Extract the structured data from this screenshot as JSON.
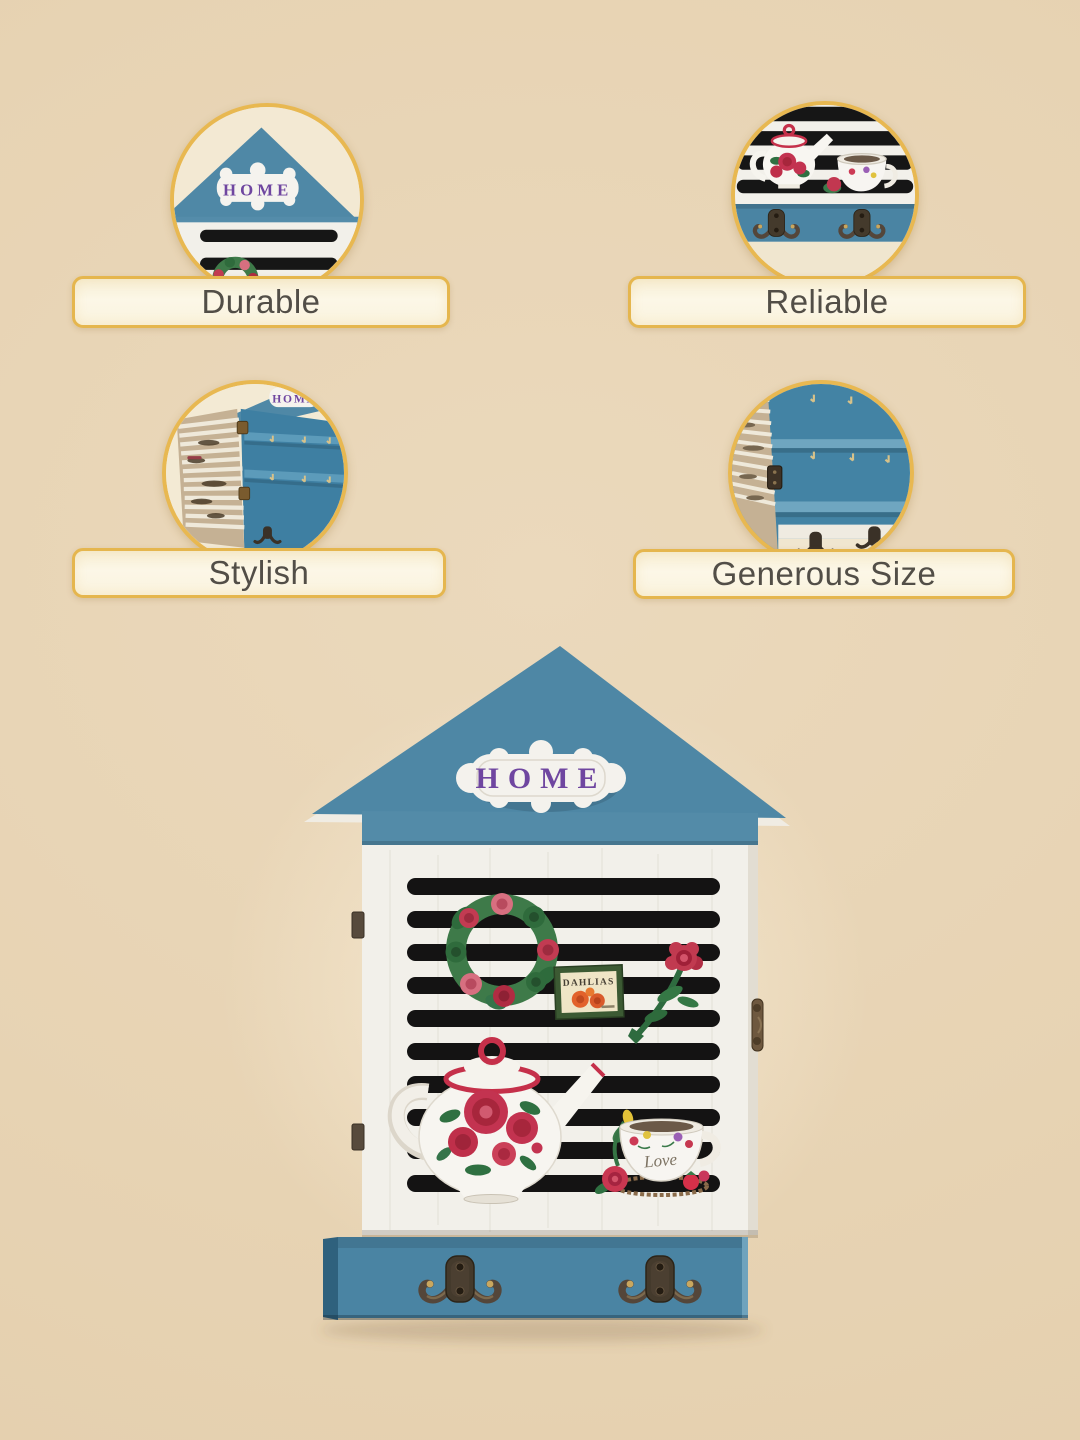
{
  "features": [
    {
      "label": "Durable"
    },
    {
      "label": "Reliable"
    },
    {
      "label": "Stylish"
    },
    {
      "label": "Generous Size"
    }
  ],
  "product": {
    "plaque_text": "HOME",
    "cup_text": "Love",
    "seed_packet_text": "DAHLIAS"
  },
  "colors": {
    "accent_gold": "#E5B64E",
    "pill_background": "#FAF3DE",
    "label_text": "#524E47",
    "roof_blue": "#4E87A5",
    "interior_blue": "#3F7EA0",
    "bar_blue": "#4A84A3",
    "body_white": "#F2F0EA",
    "slat_black": "#141313",
    "plaque_purple": "#6F46A0"
  }
}
